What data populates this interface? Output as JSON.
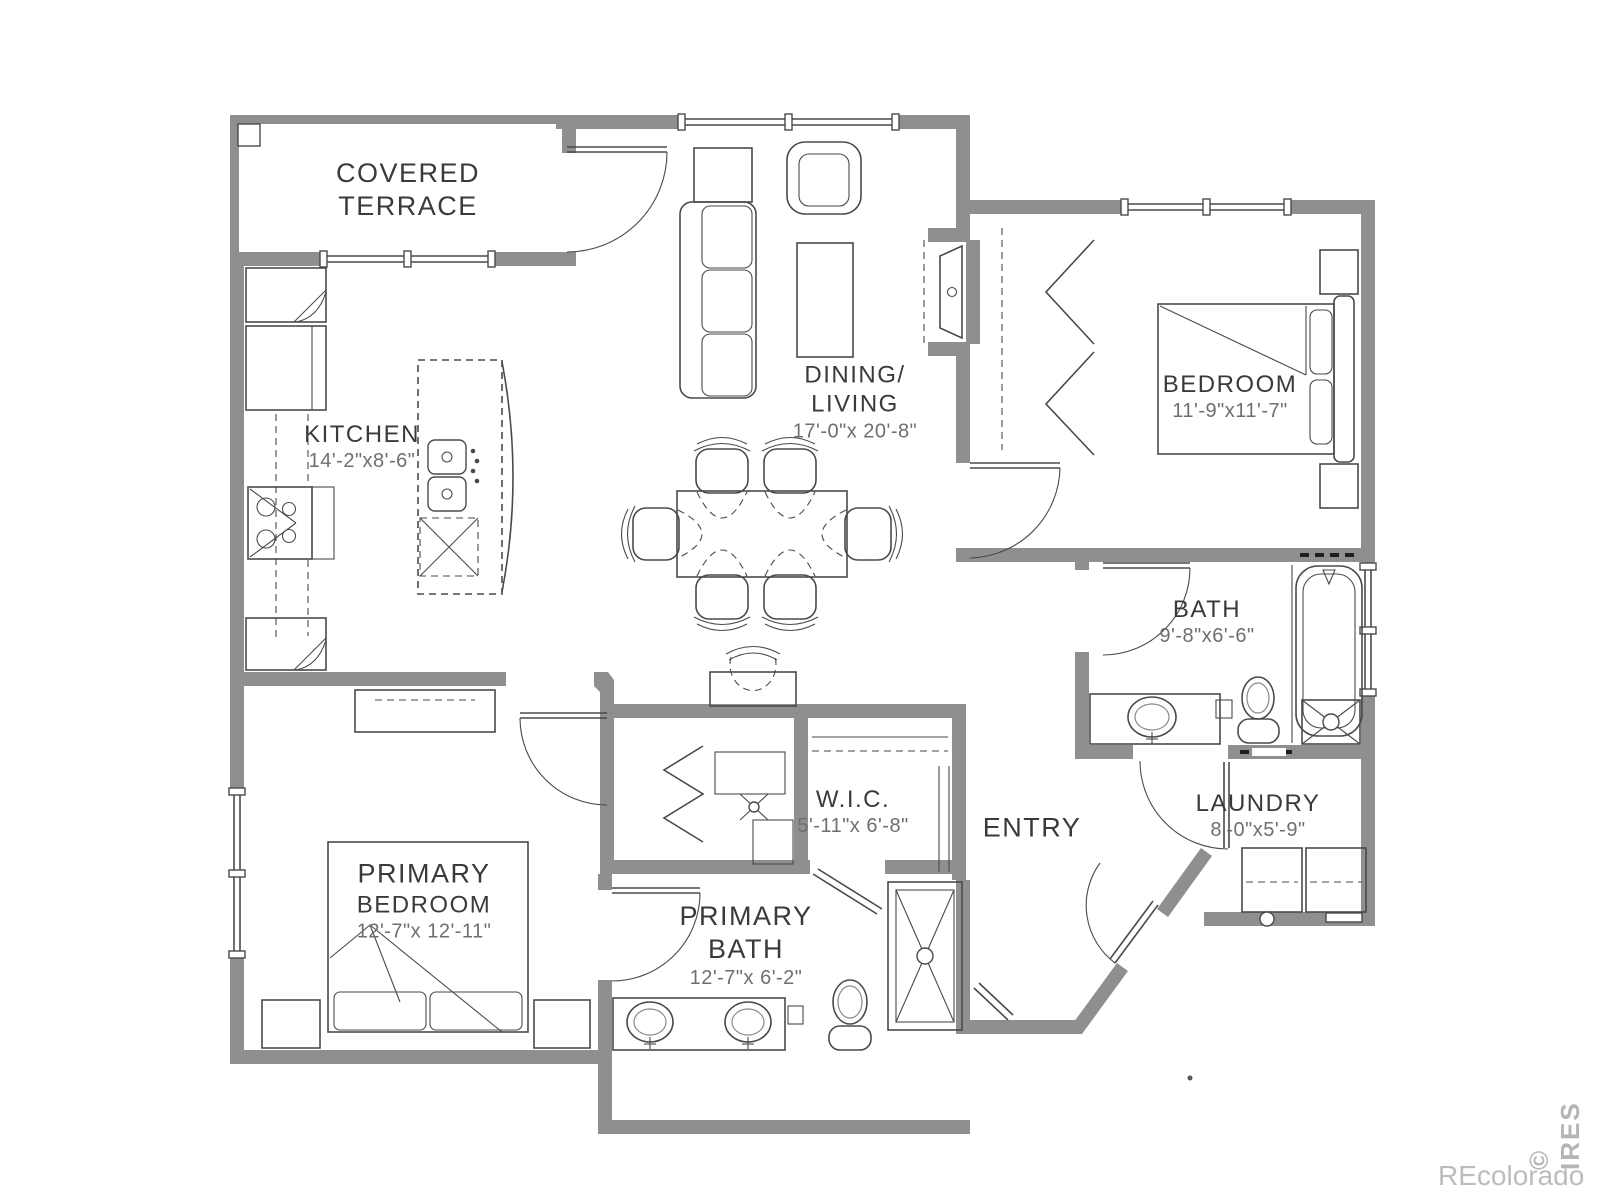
{
  "colors": {
    "wall": "#8f8f8f",
    "line": "#4a4a4a",
    "label": "#3a3a3a",
    "dim": "#6f6f6f",
    "watermark": "#bcbcbc"
  },
  "rooms": {
    "covered_terrace": {
      "name_line1": "COVERED",
      "name_line2": "TERRACE"
    },
    "kitchen": {
      "name": "KITCHEN",
      "dims": "14'-2\"x8'-6\""
    },
    "dining_living": {
      "name_line1": "DINING/",
      "name_line2": "LIVING",
      "dims": "17'-0\"x 20'-8\""
    },
    "bedroom": {
      "name": "BEDROOM",
      "dims": "11'-9\"x11'-7\""
    },
    "bath": {
      "name": "BATH",
      "dims": "9'-8\"x6'-6\""
    },
    "wic": {
      "name": "W.I.C.",
      "dims": "5'-11\"x 6'-8\""
    },
    "entry": {
      "name": "ENTRY"
    },
    "laundry": {
      "name": "LAUNDRY",
      "dims": "8'-0\"x5'-9\""
    },
    "primary_bedroom": {
      "name_line1": "PRIMARY",
      "name_line2": "BEDROOM",
      "dims": "12'-7\"x 12'-11\""
    },
    "primary_bath": {
      "name_line1": "PRIMARY",
      "name_line2": "BATH",
      "dims": "12'-7\"x 6'-2\""
    }
  },
  "watermarks": {
    "brand": "REcolorado",
    "mls": "© IRES"
  }
}
